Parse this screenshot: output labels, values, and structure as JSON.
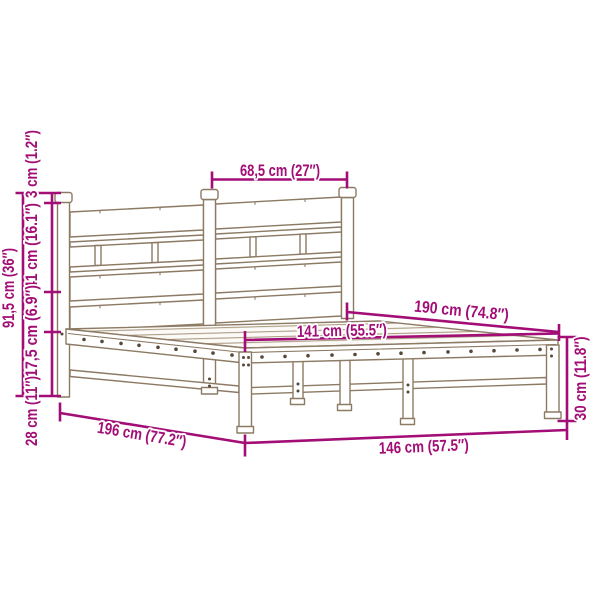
{
  "colors": {
    "dimension_accent": "#A20D76",
    "bed_outline": "#8C7A64",
    "hole_dot": "#57483A",
    "slat_line": "#A59379"
  },
  "dimensions": {
    "post_spacing": "68,5 cm (27″)",
    "finial_height": "3 cm (1.2″)",
    "headboard_panel_height": "41 cm (16.1″)",
    "rail_section_height": "17,5 cm (6.9″)",
    "under_bed_clearance": "28 cm (11″)",
    "headboard_total_height": "91,5 cm (36″)",
    "mattress_length": "190 cm (74.8″)",
    "inner_width": "141 cm (55.5″)",
    "foot_end_height": "30 cm (11.8″)",
    "total_width": "146 cm (57.5″)",
    "total_length": "196 cm (77.2″)"
  }
}
